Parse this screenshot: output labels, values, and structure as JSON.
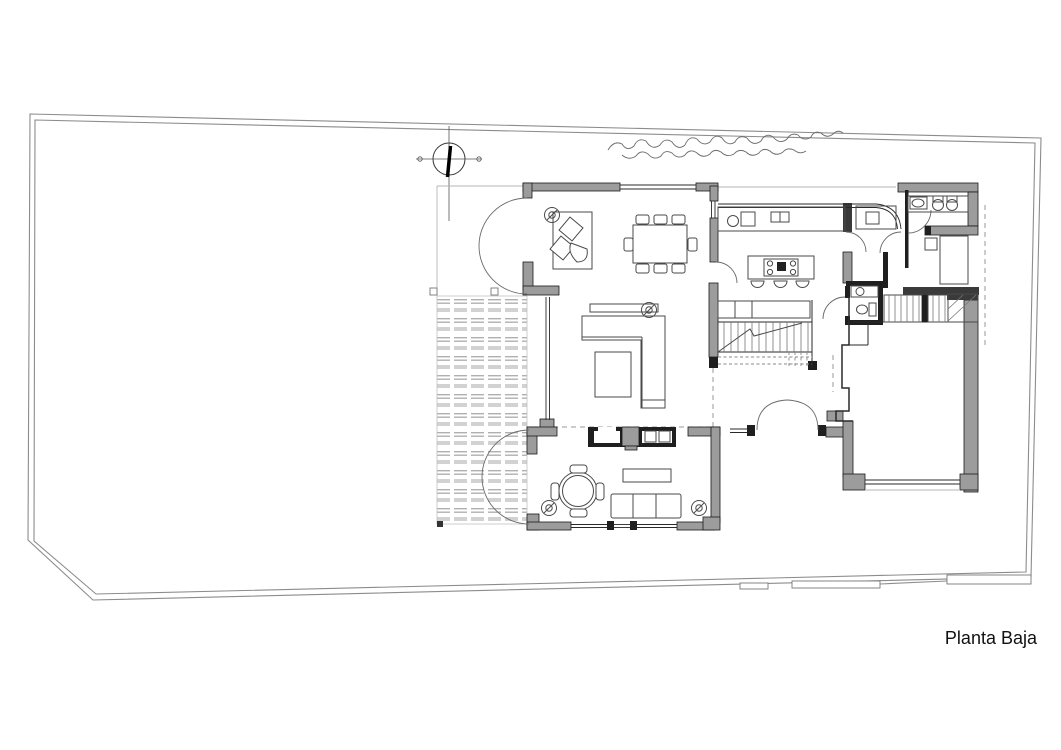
{
  "title": {
    "label": "Planta Baja"
  },
  "drawing": {
    "type": "architectural-floor-plan",
    "colors": {
      "background": "#ffffff",
      "wall_fill": "#9c9c9c",
      "wall_dark": "#1f1f1f",
      "line": "#2a2a2a",
      "boundary": "#8c8c8c",
      "deck_stripe_thin": "#b0b0b0",
      "deck_stripe_thick": "#d2d2d2",
      "door_arc": "#6a6a6a",
      "dashed": "#9a9a9a"
    }
  }
}
